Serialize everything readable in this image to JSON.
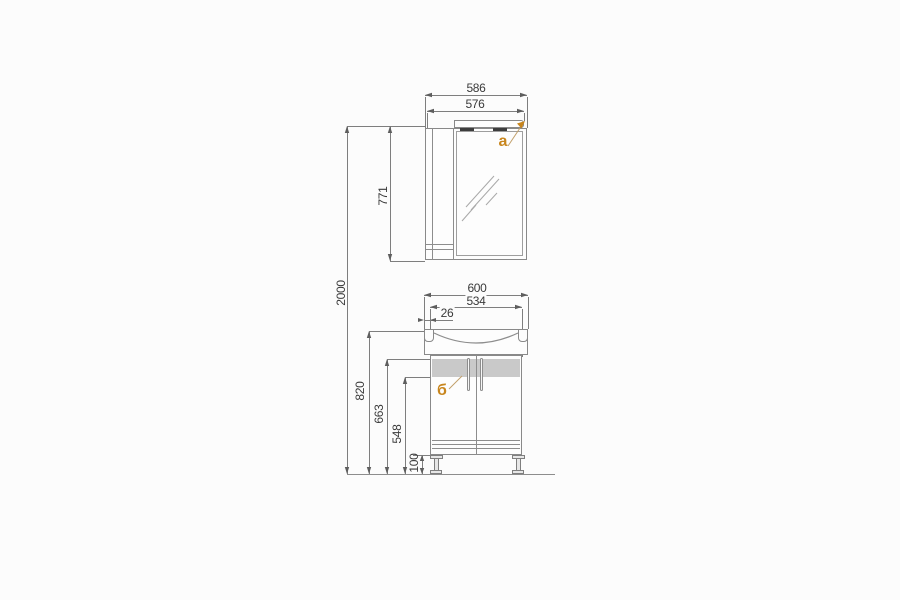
{
  "drawing_title": "bathroom-furniture-dimension-drawing",
  "labels": {
    "mirror_unit": "а",
    "base_unit": "б"
  },
  "dims": {
    "overall": {
      "total_height": "2000"
    },
    "top_unit": {
      "outer_width": "586",
      "inner_width": "576",
      "height": "771"
    },
    "bottom_unit": {
      "outer_width": "600",
      "body_width": "534",
      "edge_offset": "26",
      "rim_height": "820",
      "apron_height": "663",
      "door_height": "548",
      "leg_height": "100"
    }
  },
  "colors": {
    "accent_label": "#c8861e",
    "furniture_line": "#898989",
    "dimension_line": "#7e7e7e",
    "dimension_text": "#3a3a3a",
    "panel_gray": "#c9c9c9",
    "background": "#fcfcfc"
  }
}
